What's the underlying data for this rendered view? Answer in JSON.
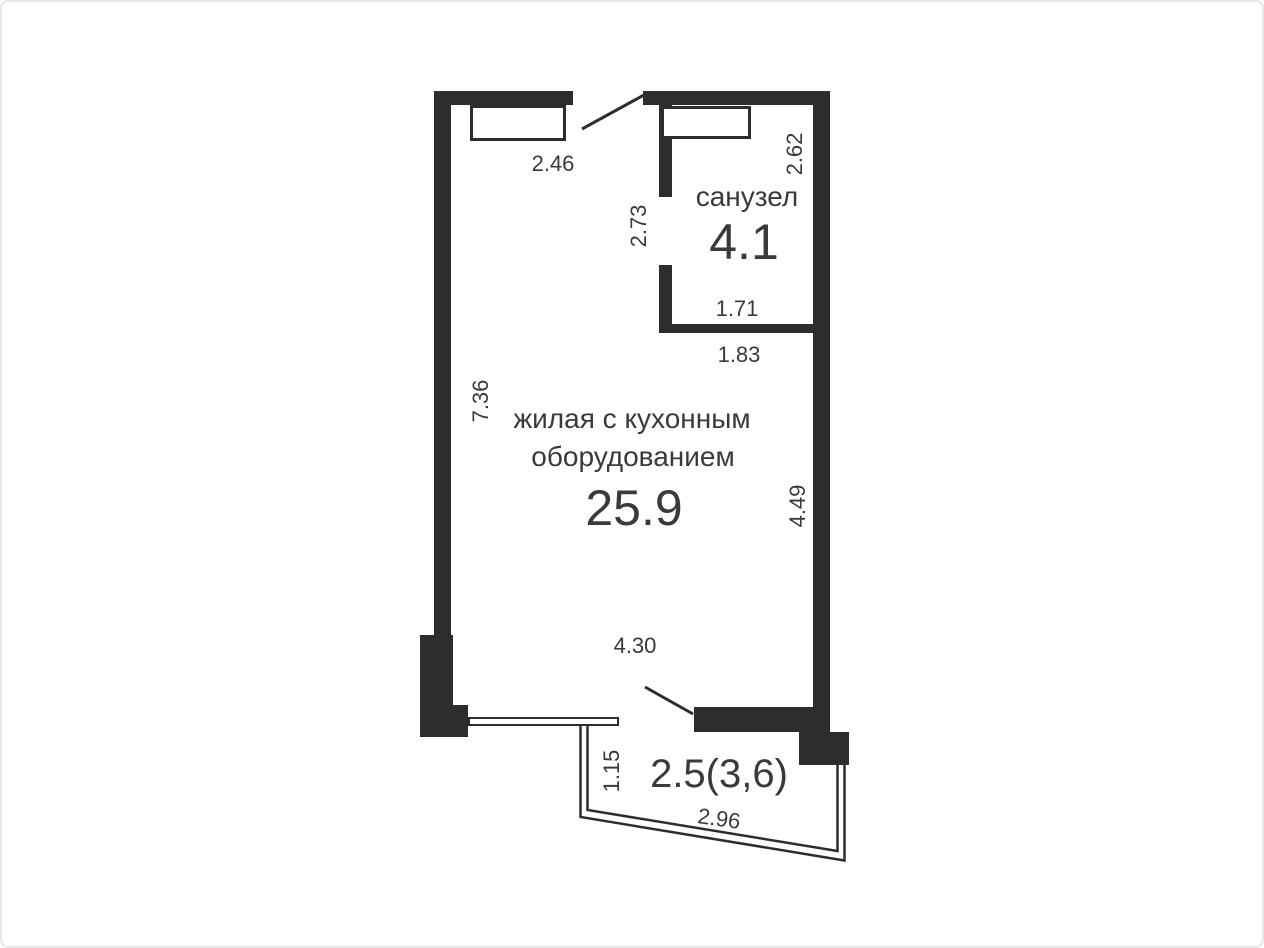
{
  "colors": {
    "wall": "#2d2d2d",
    "line": "#2d2d2d",
    "text": "#3a3a3a",
    "page_background": "#ffffff",
    "page_border": "#e7e7e7"
  },
  "rooms": {
    "living": {
      "name_line1": "жилая с кухонным",
      "name_line2": "оборудованием",
      "area": "25.9"
    },
    "bathroom": {
      "name": "санузел",
      "area": "4.1"
    },
    "balcony": {
      "area": "2.5(3,6)"
    }
  },
  "dimensions": {
    "window_width": "2.46",
    "bathroom_right_depth": "2.62",
    "bathroom_left_depth": "2.73",
    "bathroom_inner_width": "1.71",
    "bathroom_outer_width": "1.83",
    "living_left_depth": "7.36",
    "living_right_depth": "4.49",
    "living_width": "4.30",
    "balcony_depth": "1.15",
    "balcony_width": "2.96"
  }
}
